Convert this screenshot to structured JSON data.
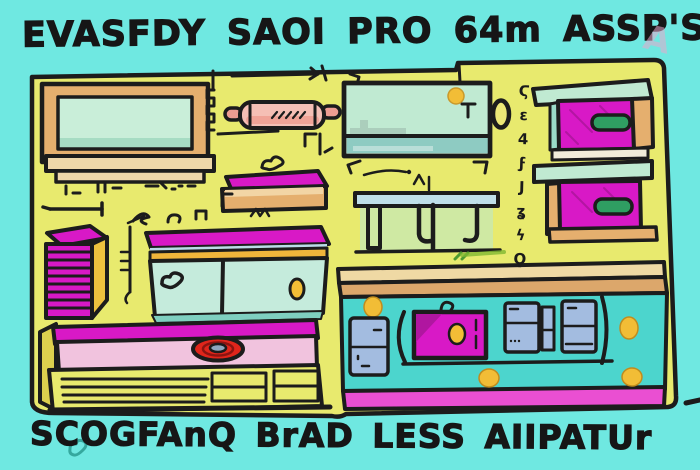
{
  "title": {
    "text": "EVASFDY SAOI PRO 64m ASSP'S"
  },
  "caption": {
    "text": "SCOGFAnQ BrAD LESS AIIPATUr"
  },
  "side_glyphs": {
    "text": "Ϛε4ϝЈʓϟϘ"
  },
  "ghost_letter": {
    "text": "A"
  },
  "colors": {
    "background": "#6fe8e1",
    "ink": "#1c1c1c",
    "panel_yellow": "#e8ea6e",
    "magenta": "#d819c6",
    "magenta_dark": "#b016a0",
    "pink_face": "#f1c3de",
    "pink_strip": "#ea4fd2",
    "salmon": "#ee9d92",
    "salmon_light": "#f5bfb5",
    "tan": "#e5af6e",
    "tan_light": "#eed7a9",
    "counter_bar_light": "#efd9a4",
    "counter_bar_dark": "#dca76b",
    "mint": "#c0ead2",
    "mint_deep": "#8ecbc2",
    "teal_counter": "#4cd5cd",
    "pale_green": "#cfe9a3",
    "table_blue": "#bfdfe9",
    "blue_gray": "#a3bce0",
    "knob_yellow": "#f2bd36",
    "knob_red": "#e0251b",
    "knob_center": "#8fa6bd",
    "handle_green": "#2f9e62",
    "orange_band": "#f0b53b",
    "side_yellow": "#eec23e",
    "leaf_green": "#4f9b30",
    "heart_teal": "#35a89e"
  }
}
